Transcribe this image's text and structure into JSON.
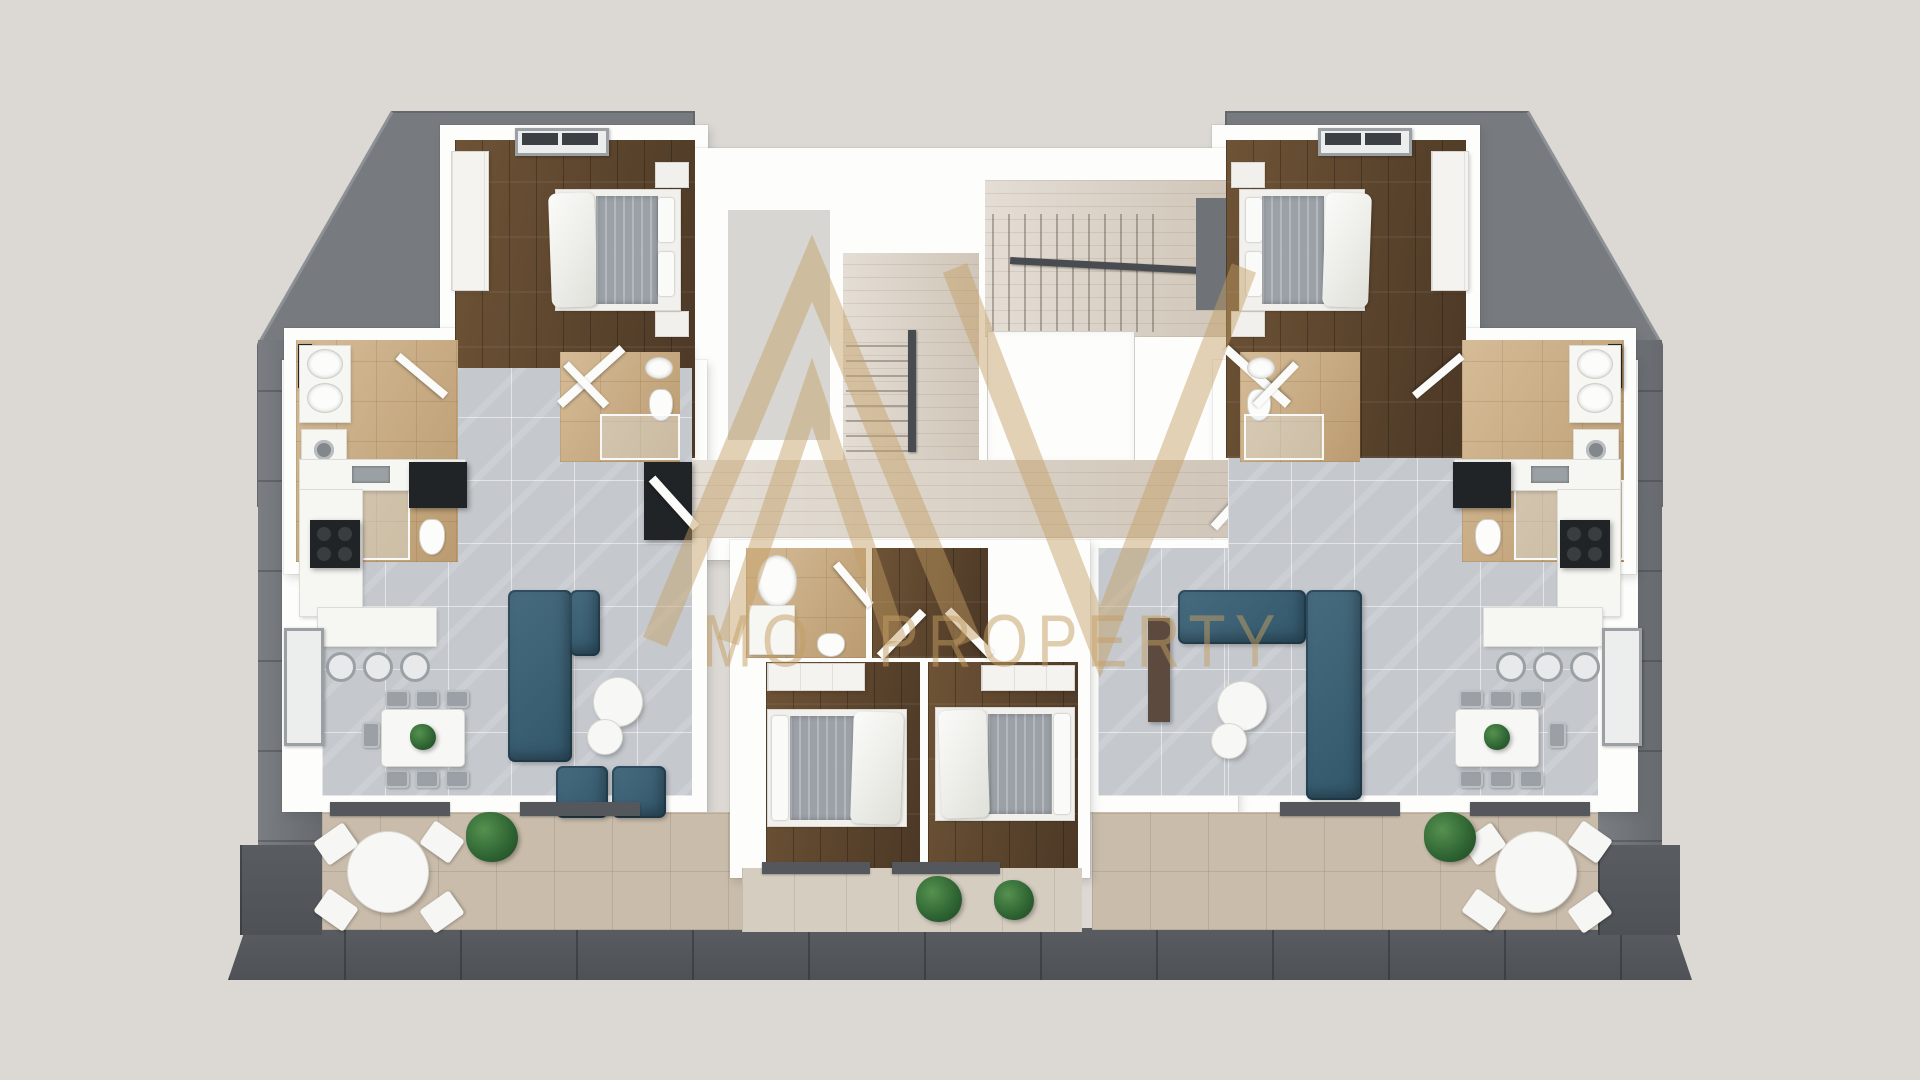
{
  "scene": {
    "description": "3D rendered top-down floor plan of a residential attic floor: two mirrored apartments around a central staircase and elevator core, grey hip roof surround",
    "view": "top-down 3D render"
  },
  "watermark": {
    "mark": "double-triangle monogram",
    "text_left": "MO",
    "text_right": "PROPERTY",
    "color": "#c49e63"
  },
  "palette": {
    "bg": "#dcd9d4",
    "roof": "#7a7e82",
    "roofBottom": "#595d61",
    "wall": "#fdfdfc",
    "wood": "#5e4731",
    "tileGrey": "#c5c9ce",
    "tileBeige": "#c7a87e",
    "travertine": "#d8cfc3",
    "terrace": "#c9bcab",
    "sofa": "#32576b",
    "sofaLight": "#476b7e",
    "plant": "#2e6332",
    "black": "#212427",
    "chairGrey": "#9aa0a5",
    "watermark": "#c49e63"
  },
  "building": {
    "core_rooms": [
      "staircase",
      "elevator",
      "entry-corridor",
      "hall"
    ],
    "apartments": [
      {
        "side": "left",
        "rooms": [
          "bedroom",
          "ensuite-bathroom",
          "bathroom",
          "open-plan-living-kitchen",
          "terrace"
        ]
      },
      {
        "side": "center",
        "rooms": [
          "bathroom",
          "bedroom",
          "bedroom",
          "balcony"
        ]
      },
      {
        "side": "right",
        "rooms": [
          "bedroom",
          "ensuite-bathroom",
          "bathroom",
          "open-plan-living-kitchen",
          "terrace"
        ]
      }
    ],
    "furniture": [
      "double-bed",
      "wardrobe",
      "washbasin",
      "mirror-cabinet",
      "shower",
      "toilet",
      "washing-machine",
      "kitchen-counter",
      "cooktop",
      "kitchen-island",
      "bar-stools",
      "dining-table",
      "dining-chairs",
      "sectional-sofa",
      "armchairs",
      "coffee-tables",
      "tv-unit",
      "round-terrace-table",
      "terrace-chairs",
      "plants",
      "roof-windows",
      "stairs",
      "handrail"
    ]
  }
}
